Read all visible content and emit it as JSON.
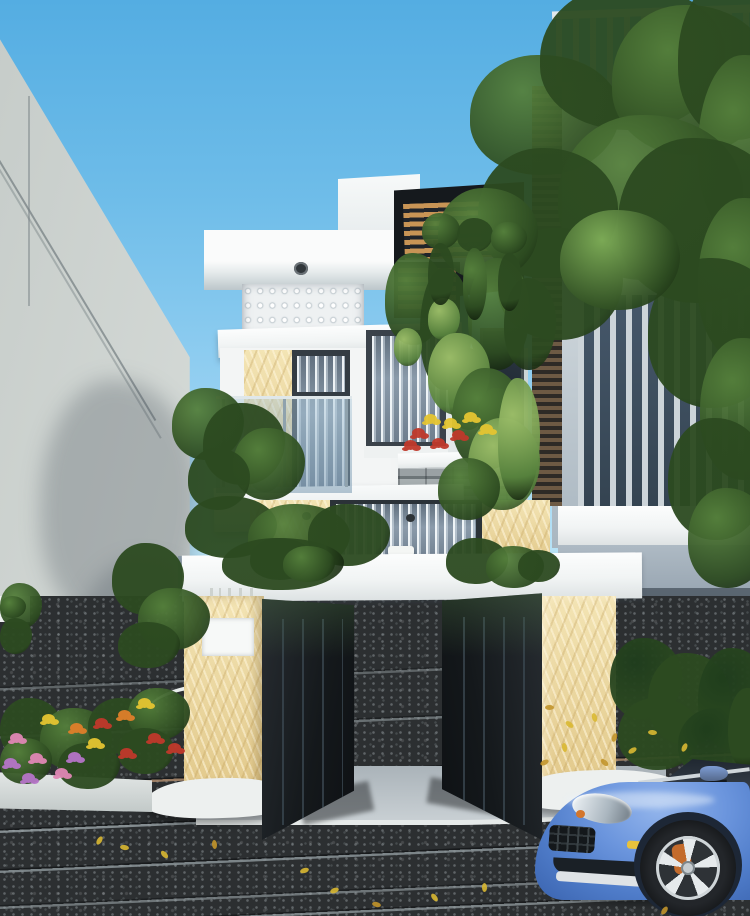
{
  "scene": {
    "type": "architectural-exterior-rendering",
    "caption": "Photorealistic rendering of a modern three-storey townhouse with white slab facades, yellow marble accents, a perforated breeze-block screen, glass balcony railing with a large vase, dark metal entrance gates between marble pillars, lush trees and planters, neighbouring grey buildings, a dark asphalt street with fallen yellow leaves, and a blue sports car parked at the curb.",
    "objects": [
      "sky",
      "left-neighbor-building",
      "right-neighbor-building",
      "street-tree",
      "main-house",
      "rooftop-pergola",
      "breeze-block-screen",
      "second-floor-balcony",
      "glass-railing",
      "planter-vase",
      "flower-planter",
      "stone-clad-planter",
      "compound-wall",
      "entrance-gates",
      "gate-pillars",
      "house-number-plate",
      "driveway-apron",
      "asphalt-road",
      "flower-bed",
      "blue-sports-car"
    ],
    "palette": {
      "sky_top": "#54ade2",
      "sky_horizon": "#d9f0fa",
      "left_wall": "#ccd2cf",
      "facade_white": "#f6f8f8",
      "marble": "#e9d49b",
      "dark_frame": "#272d33",
      "gate_black": "#1a1f23",
      "glass_blue": "#8796a6",
      "railing_glass": "#9fc0d4",
      "stone_gray": "#8d9598",
      "pergola_wood": "#c89455",
      "asphalt": "#2c2f31",
      "concrete": "#aeb7bd",
      "car_blue": "#5d87d3",
      "caliper_orange": "#d2691e",
      "foliage_mid": "#55803c",
      "foliage_dark": "#2c4a20",
      "foliage_light": "#7fae58",
      "foliage_yellowgreen": "#9ec06a",
      "foliage_deep": "#1f3d1c",
      "flower_pink": "#e087b5",
      "flower_red": "#c0392b",
      "flower_orange": "#df7f2a",
      "flower_yellow": "#e5c531",
      "flower_purple": "#b675c8",
      "leaf_yellow": "#d9b832",
      "pot_terracotta": "#9a5632",
      "vase_gray": "#93a4ad"
    }
  }
}
